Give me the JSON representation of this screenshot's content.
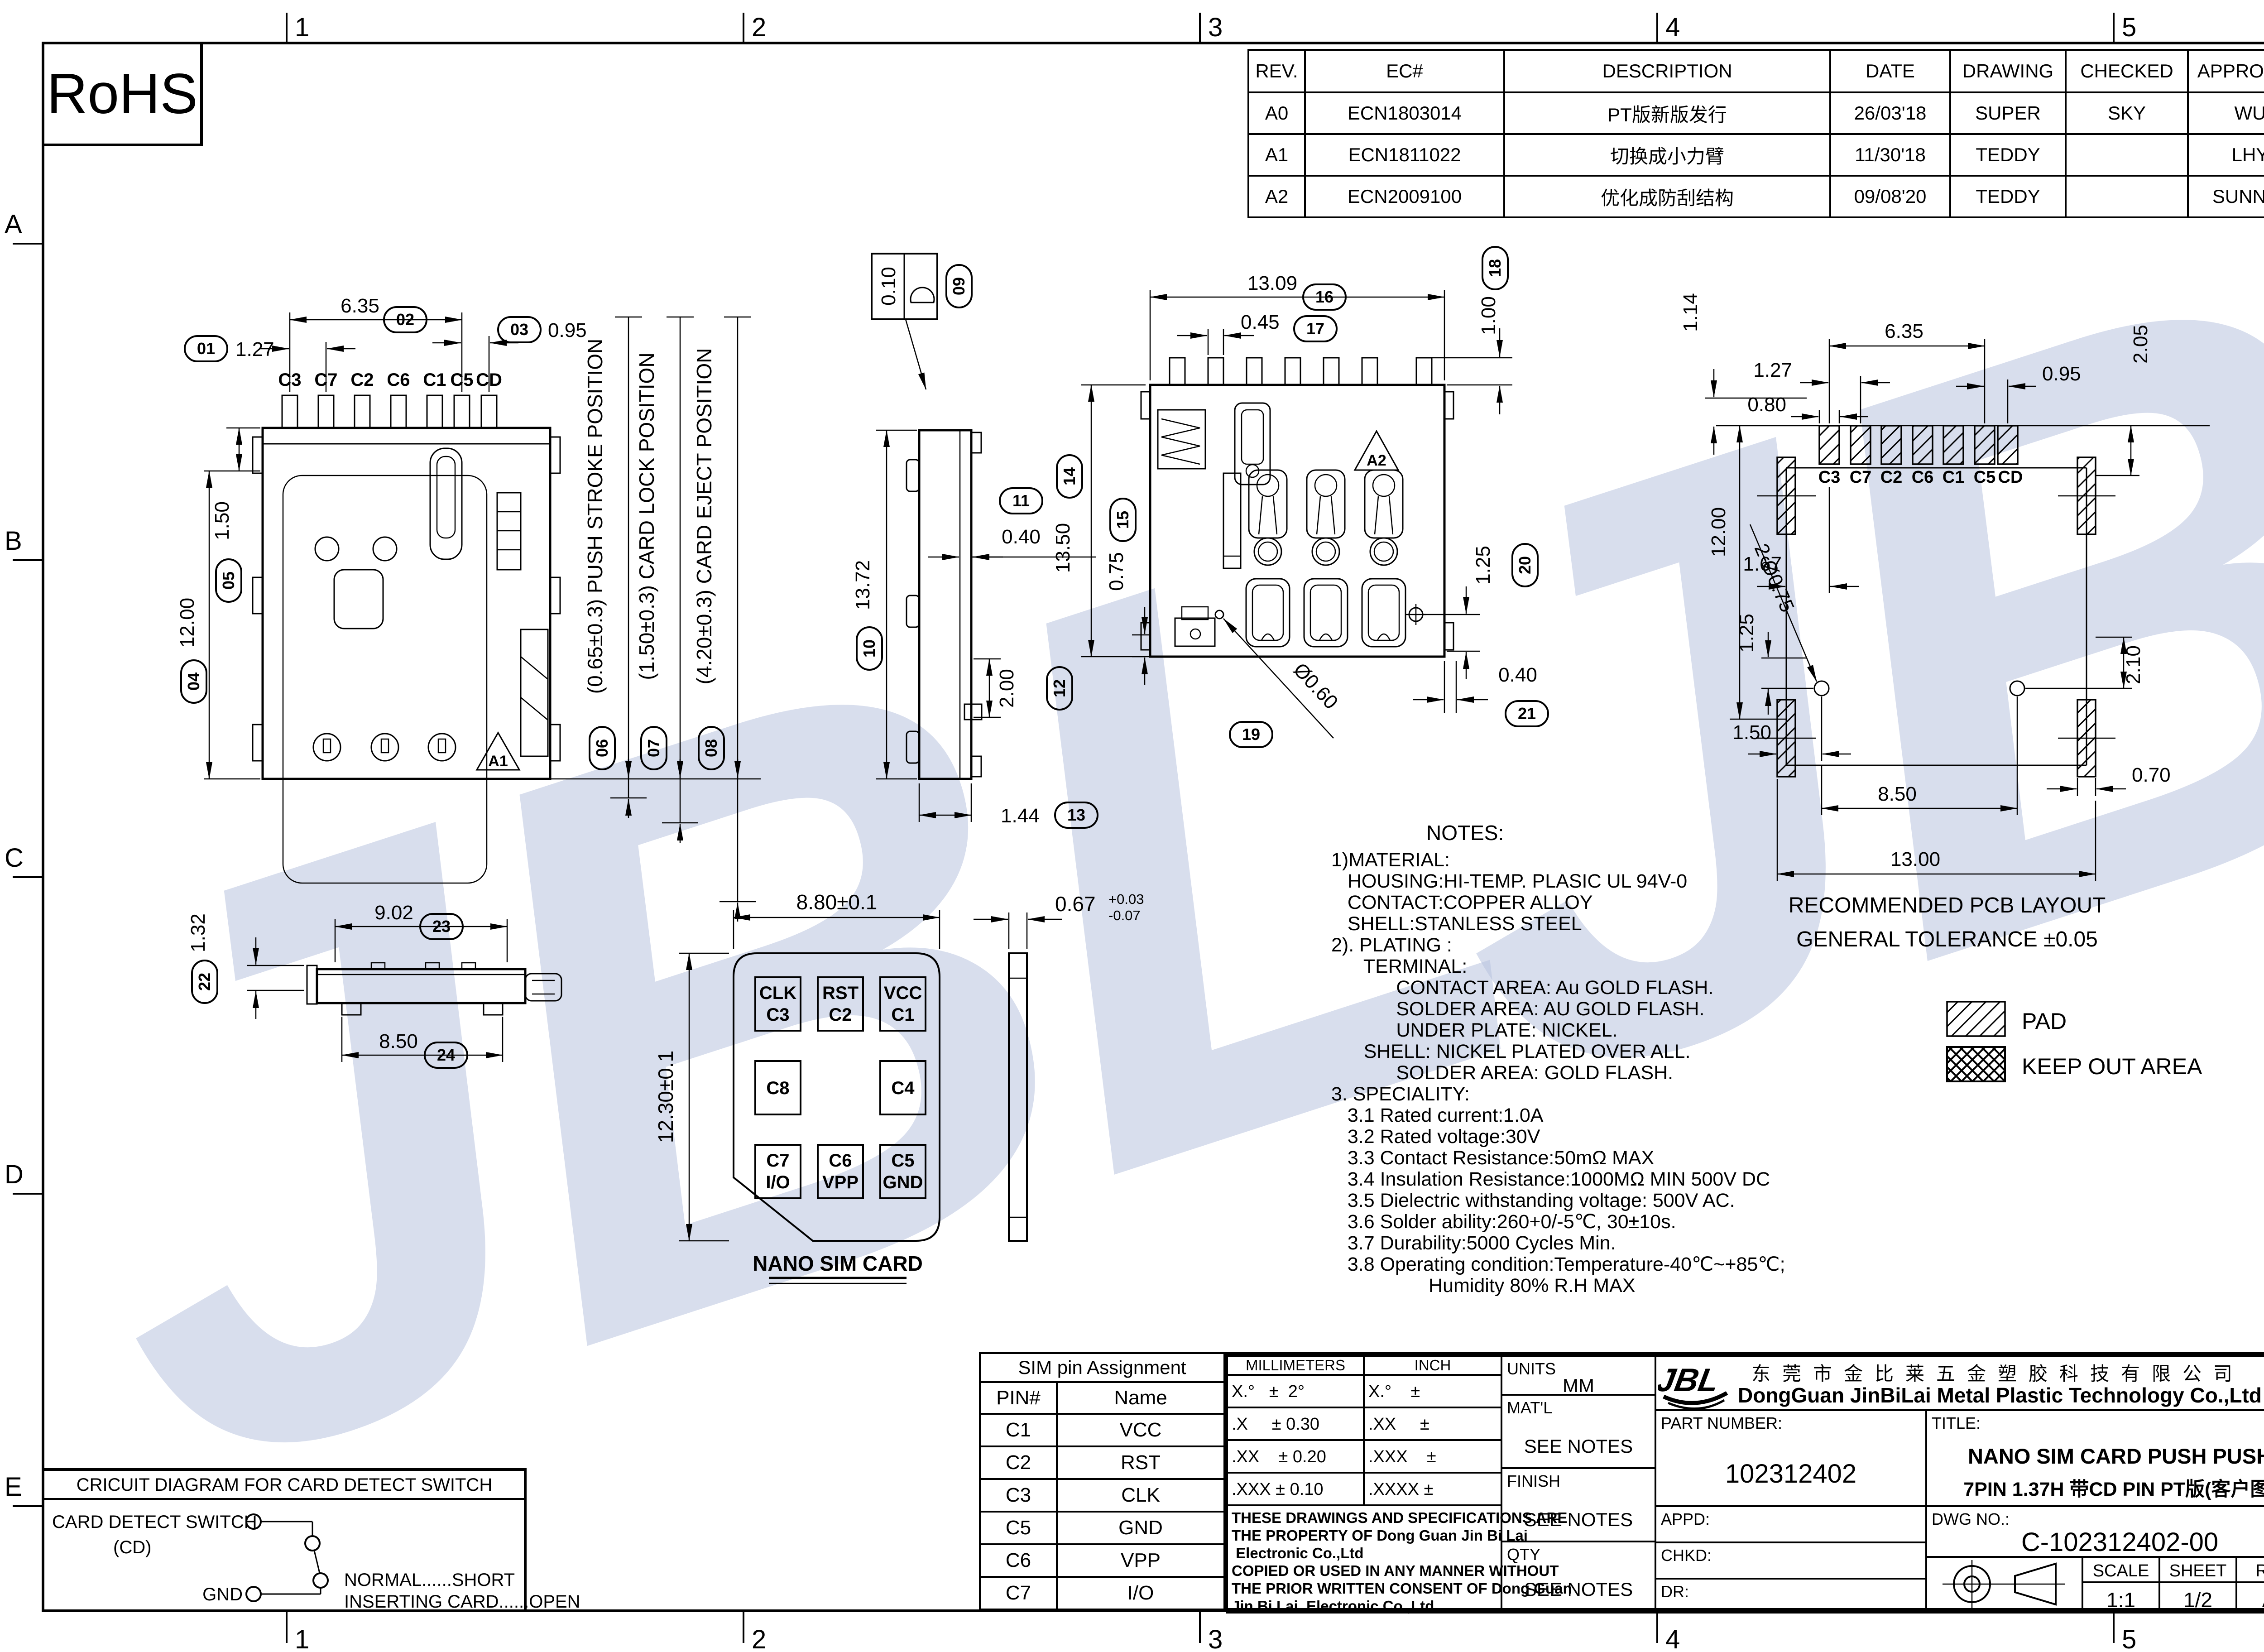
{
  "watermark": {
    "text": "JBL",
    "color": "#b9c4e0"
  },
  "zones": {
    "cols": [
      "1",
      "2",
      "3",
      "4",
      "5"
    ],
    "rows": [
      "A",
      "B",
      "C",
      "D",
      "E"
    ]
  },
  "rohs": "RoHS",
  "rev_table": {
    "headers": [
      "REV.",
      "EC#",
      "DESCRIPTION",
      "DATE",
      "DRAWING",
      "CHECKED",
      "APPROVED"
    ],
    "rows": [
      [
        "A0",
        "ECN1803014",
        "PT版新版发行",
        "26/03'18",
        "SUPER",
        "SKY",
        "WU"
      ],
      [
        "A1",
        "ECN1811022",
        "切换成小力臂",
        "11/30'18",
        "TEDDY",
        "",
        "LHY"
      ],
      [
        "A2",
        "ECN2009100",
        "优化成防刮结构",
        "09/08'20",
        "TEDDY",
        "",
        "SUNNLY"
      ]
    ]
  },
  "front": {
    "pins": [
      "C3",
      "C7",
      "C2",
      "C6",
      "C1",
      "C5",
      "CD"
    ],
    "d01": {
      "n": "01",
      "v": "1.27"
    },
    "d02": {
      "n": "02",
      "v": "6.35"
    },
    "d03": {
      "n": "03",
      "v": "0.95"
    },
    "d04": {
      "n": "04",
      "v": "12.00"
    },
    "d05": {
      "n": "05",
      "v": "1.50"
    },
    "pos06": {
      "n": "06",
      "v": "(0.65±0.3) PUSH STROKE POSITION"
    },
    "pos07": {
      "n": "07",
      "v": "(1.50±0.3) CARD LOCK POSITION"
    },
    "pos08": {
      "n": "08",
      "v": "(4.20±0.3) CARD EJECT POSITION"
    },
    "marker": "A1"
  },
  "side": {
    "d09": {
      "n": "09",
      "v": "0.10"
    },
    "d10": {
      "n": "10",
      "v": "13.72"
    },
    "d11": {
      "n": "11",
      "v": "0.40"
    },
    "d12": {
      "n": "12",
      "v": "2.00"
    },
    "d13": {
      "n": "13",
      "v": "1.44"
    }
  },
  "bottom": {
    "d14": {
      "n": "14",
      "v": "13.50"
    },
    "d15": {
      "n": "15",
      "v": "0.75"
    },
    "d16": {
      "n": "16",
      "v": "13.09"
    },
    "d17": {
      "n": "17",
      "v": "0.45"
    },
    "d18": {
      "n": "18",
      "v": "1.00"
    },
    "d19": {
      "n": "19",
      "v": "Ø0.60"
    },
    "d20": {
      "n": "20",
      "v": "1.25"
    },
    "d21": {
      "n": "21",
      "v": "0.40"
    },
    "marker": "A2"
  },
  "profile": {
    "d22": {
      "n": "22",
      "v": "1.32"
    },
    "d23": {
      "n": "23",
      "v": "9.02"
    },
    "d24": {
      "n": "24",
      "v": "8.50"
    }
  },
  "sim": {
    "w": "8.80±0.1",
    "h": "12.30±0.1",
    "t": "0.67",
    "tsup": "+0.03",
    "tsub": "-0.07",
    "pads": [
      {
        "a": "CLK",
        "b": "C3"
      },
      {
        "a": "RST",
        "b": "C2"
      },
      {
        "a": "VCC",
        "b": "C1"
      },
      {
        "a": "C8",
        "b": ""
      },
      {
        "a": "C4",
        "b": ""
      },
      {
        "a": "C7",
        "b": "I/O"
      },
      {
        "a": "C6",
        "b": "VPP"
      },
      {
        "a": "C5",
        "b": "GND"
      }
    ],
    "label": "NANO SIM CARD"
  },
  "pcb": {
    "d635": "6.35",
    "d127": "1.27",
    "d080": "0.80",
    "d095": "0.95",
    "d114": "1.14",
    "d205": "2.05",
    "d167": "1.67",
    "d1200": "12.00",
    "d125": "1.25",
    "holes": "2-Ø0.75",
    "d210": "2.10",
    "d150": "1.50",
    "d850": "8.50",
    "d1300": "13.00",
    "d070": "0.70",
    "rec1": "RECOMMENDED PCB LAYOUT",
    "rec2": "GENERAL TOLERANCE ±0.05"
  },
  "legend": {
    "pad": "PAD",
    "keep": "KEEP OUT AREA"
  },
  "notes": {
    "title": "NOTES:",
    "body": "1)MATERIAL:\n   HOUSING:HI-TEMP. PLASIC UL 94V-0\n   CONTACT:COPPER ALLOY\n   SHELL:STANLESS STEEL\n2). PLATING :\n      TERMINAL:\n            CONTACT AREA: Au GOLD FLASH.\n            SOLDER AREA: AU GOLD FLASH.\n            UNDER PLATE: NICKEL.\n      SHELL: NICKEL PLATED OVER ALL.\n            SOLDER AREA: GOLD FLASH.\n3. SPECIALITY:\n   3.1 Rated current:1.0A\n   3.2 Rated voltage:30V\n   3.3 Contact Resistance:50mΩ MAX\n   3.4 Insulation Resistance:1000MΩ MIN 500V DC\n   3.5 Dielectric withstanding voltage: 500V AC.\n   3.6 Solder ability:260+0/-5℃, 30±10s.\n   3.7 Durability:5000 Cycles Min.\n   3.8 Operating condition:Temperature-40℃~+85℃;\n                  Humidity 80% R.H MAX"
  },
  "circuit": {
    "title": "CRICUIT DIAGRAM FOR CARD DETECT SWITCH",
    "l1": "CARD DETECT SWITCH",
    "l2": "(CD)",
    "gn": "GND",
    "n1": "NORMAL......SHORT",
    "n2": "INSERTING CARD......OPEN"
  },
  "pin_table": {
    "title": "SIM pin Assignment",
    "headers": [
      "PIN#",
      "Name"
    ],
    "rows": [
      [
        "C1",
        "VCC"
      ],
      [
        "C2",
        "RST"
      ],
      [
        "C3",
        "CLK"
      ],
      [
        "C5",
        "GND"
      ],
      [
        "C6",
        "VPP"
      ],
      [
        "C7",
        "I/O"
      ]
    ]
  },
  "tb": {
    "tol_headers": [
      "MILLIMETERS",
      "INCH"
    ],
    "tol_rows": [
      [
        "X.°   ±  2°",
        "X.°    ±"
      ],
      [
        ".X     ± 0.30",
        ".XX     ±"
      ],
      [
        ".XX    ± 0.20",
        ".XXX    ±"
      ],
      [
        ".XXX ± 0.10",
        ".XXXX ±"
      ]
    ],
    "legal": "THESE DRAWINGS AND SPECIFICATIONS ARE\nTHE PROPERTY OF Dong Guan Jin Bi Lai\n Electronic Co.,Ltd\nCOPIED OR USED IN ANY MANNER WITHOUT\nTHE PRIOR WRITTEN CONSENT OF Dong Guan\nJin Bi Lai  Electronic Co.,Ltd",
    "units_l": "UNITS",
    "units_v": "MM",
    "matl": "MAT'L",
    "finish": "FINISH",
    "qty": "QTY",
    "see_notes": "SEE NOTES",
    "pn_l": "PART NUMBER:",
    "pn": "102312402",
    "appd": "APPD:",
    "chkd": "CHKD:",
    "dr": "DR:",
    "logo": "JBL",
    "co_cn": "东莞市金比莱五金塑胶科技有限公司",
    "co_en": "DongGuan JinBiLai Metal Plastic Technology Co.,Ltd",
    "title_l": "TITLE:",
    "t1": "NANO SIM CARD PUSH PUSH",
    "t2": "7PIN 1.37H 带CD PIN PT版(客户图)",
    "dwg_l": "DWG NO.:",
    "dwg": "C-102312402-00",
    "scale_l": "SCALE",
    "scale": "1:1",
    "sheet_l": "SHEET",
    "sheet": "1/2",
    "rev_l": "REV.",
    "rev": "A2"
  }
}
